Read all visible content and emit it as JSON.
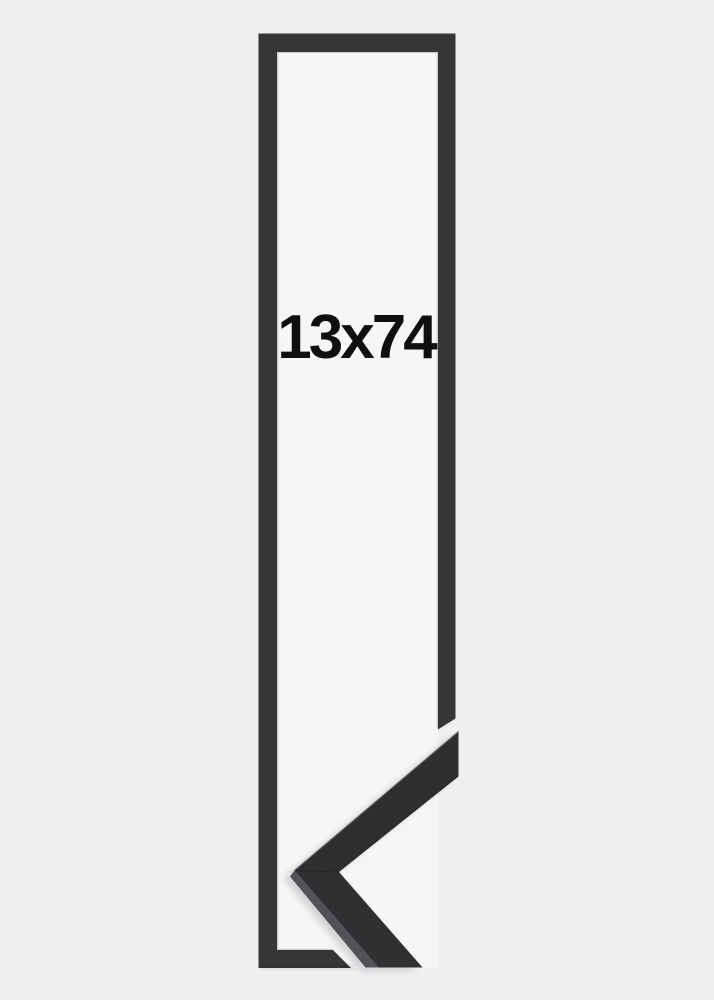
{
  "product_image": {
    "subject": "picture-frame",
    "size_label": "13x74",
    "colors": {
      "page_background": "#f0f0f1",
      "opening_background": "#f6f6f7",
      "frame_face": "#363639",
      "frame_inner_highlight": "#9c9c9e",
      "profile_face_top": "#2e2e31",
      "profile_face_bottom": "#303033",
      "profile_top_surface": "#525256",
      "profile_edge_highlight": "#616165",
      "profile_seam": "#1c1c1e",
      "label_text": "#0f0f0f"
    }
  }
}
